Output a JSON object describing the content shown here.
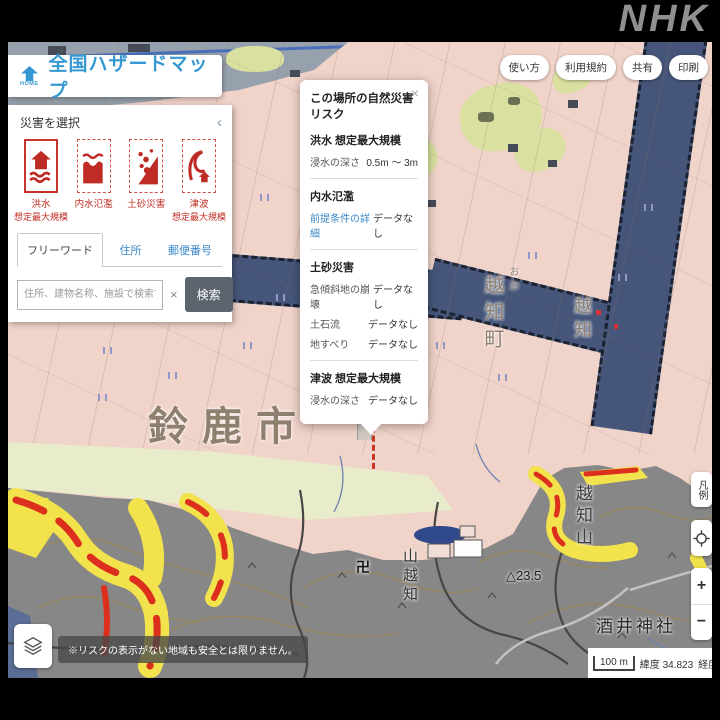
{
  "logo": {
    "text": "NHK"
  },
  "header": {
    "home_label": "HOME",
    "title": "全国ハザードマップ",
    "menu": {
      "howto": "使い方",
      "terms": "利用規約",
      "share": "共有",
      "print": "印刷"
    }
  },
  "panel": {
    "title": "災害を選択",
    "collapse": "‹",
    "disasters": [
      {
        "label": "洪水",
        "sublabel": "想定最大規模"
      },
      {
        "label": "内水氾濫",
        "sublabel": ""
      },
      {
        "label": "土砂災害",
        "sublabel": ""
      },
      {
        "label": "津波",
        "sublabel": "想定最大規模"
      }
    ],
    "tabs": {
      "freeword": "フリーワード",
      "address": "住所",
      "zipcode": "郵便番号"
    },
    "search": {
      "placeholder": "住所、建物名称、施設で検索できます",
      "clear": "×",
      "button": "検索"
    }
  },
  "popup": {
    "title": "この場所の自然災害リスク",
    "close": "×",
    "flood": {
      "title": "洪水 想定最大規模",
      "row_label": "浸水の深さ",
      "row_value": "0.5m ～ 3m"
    },
    "naisui": {
      "title": "内水氾濫",
      "link": "前提条件の詳細",
      "value": "データなし"
    },
    "dosha": {
      "title": "土砂災害",
      "rows": [
        {
          "label": "急傾斜地の崩壊",
          "value": "データなし"
        },
        {
          "label": "土石流",
          "value": "データなし"
        },
        {
          "label": "地すべり",
          "value": "データなし"
        }
      ]
    },
    "tsunami": {
      "title": "津波 想定最大規模",
      "row_label": "浸水の深さ",
      "row_value": "データなし"
    }
  },
  "map": {
    "labels": {
      "city": "鈴鹿市",
      "town": "越知町",
      "oo": "おお",
      "ochi": "越知",
      "ochiyama": "越知山",
      "yamaochi": "山越知",
      "shrine": "酒井神社",
      "elevation": "△23.5",
      "temple": "卍"
    }
  },
  "controls": {
    "legend": "凡例",
    "zoom_in": "+",
    "zoom_out": "−"
  },
  "footer": {
    "disclaimer": "※リスクの表示がない地域も安全とは限りません。",
    "scale": "100 m",
    "lat_label": "緯度",
    "lat_value": "34.823",
    "lng_label": "経度",
    "lng_value": "136.53"
  },
  "colors": {
    "accent_blue": "#3598d2",
    "hazard_red": "#dc2f1e",
    "hazard_yellow": "#f2e24c",
    "flood_pink": "#f0d3c9",
    "river_blue": "#46567a",
    "link_blue": "#3b87c8"
  }
}
